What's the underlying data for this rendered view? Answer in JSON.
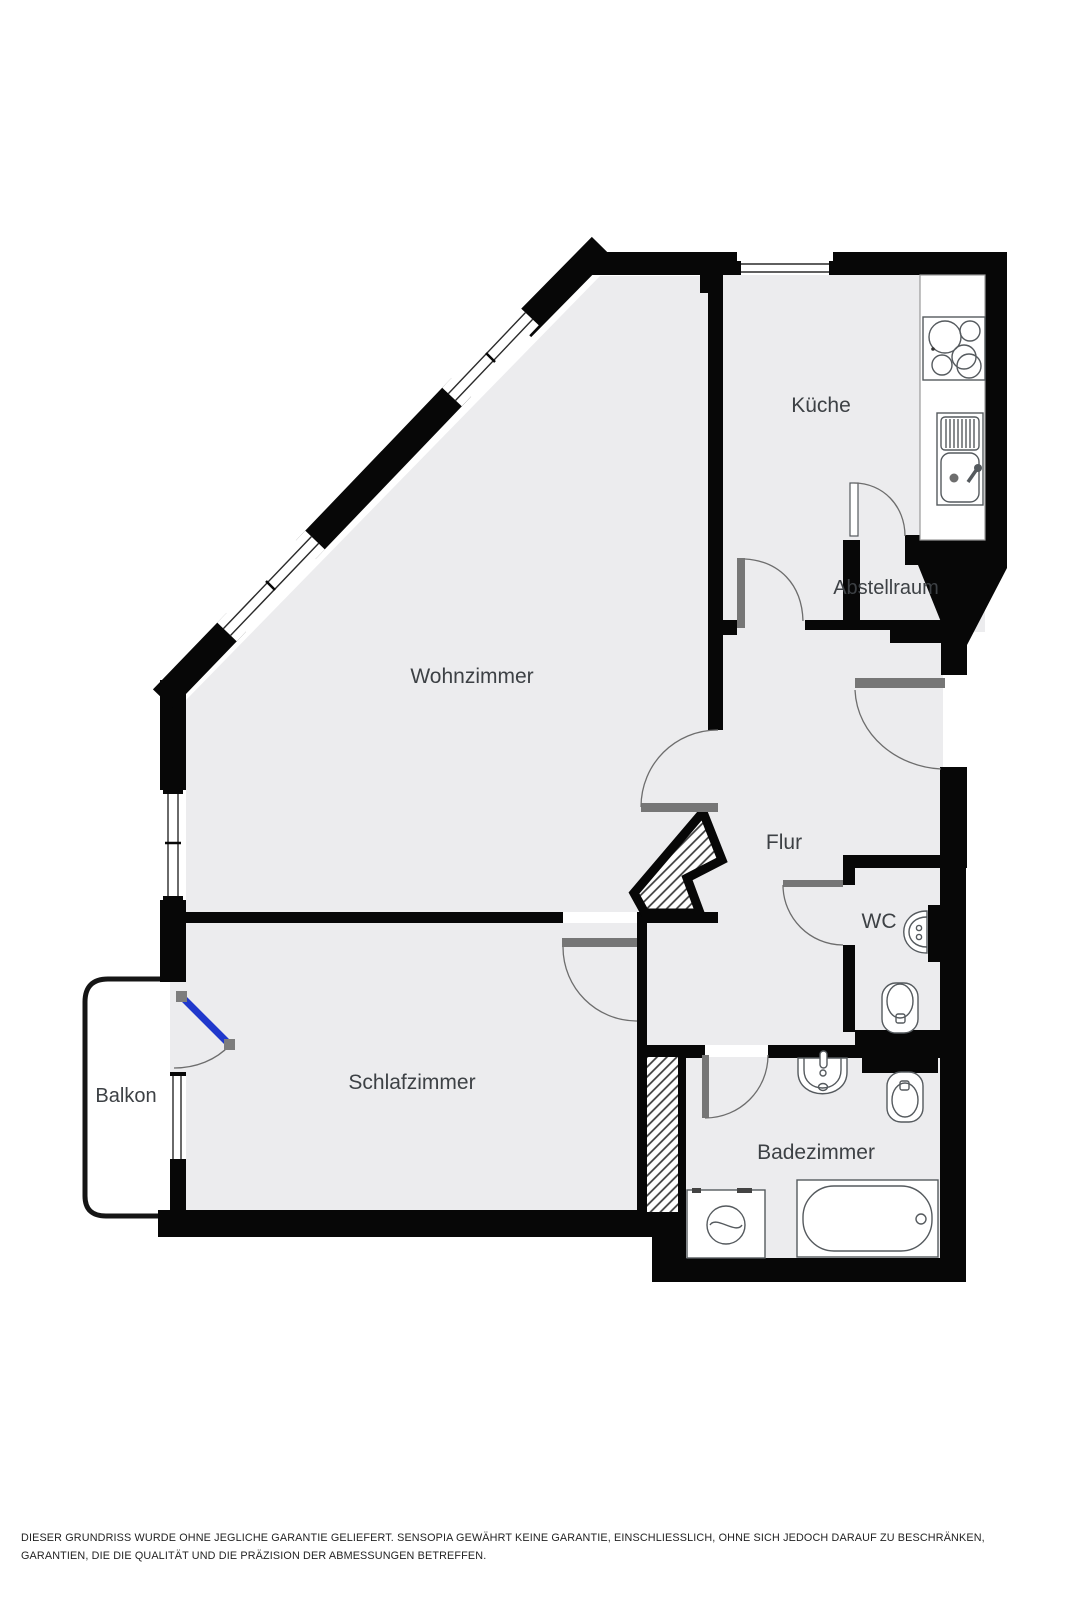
{
  "floorplan": {
    "rooms": [
      {
        "id": "kueche",
        "label": "Küche"
      },
      {
        "id": "wohnzimmer",
        "label": "Wohnzimmer"
      },
      {
        "id": "abstellraum",
        "label": "Abstellraum"
      },
      {
        "id": "flur",
        "label": "Flur"
      },
      {
        "id": "wc",
        "label": "WC"
      },
      {
        "id": "schlafzimmer",
        "label": "Schlafzimmer"
      },
      {
        "id": "balkon",
        "label": "Balkon"
      },
      {
        "id": "badezimmer",
        "label": "Badezimmer"
      }
    ],
    "fixtures": [
      "stove-icon",
      "kitchen-sink-icon",
      "wc-sink-icon",
      "wc-toilet-icon",
      "bathroom-sink-icon",
      "bathroom-toilet-icon",
      "bathtub-icon",
      "washing-machine-icon"
    ],
    "colors": {
      "wall": "#070707",
      "floor": "#ececee",
      "door_leaf": "#767676",
      "balcony_door": "#2038cc",
      "label": "#3d4145",
      "disclaimer": "#232323"
    }
  },
  "disclaimer": {
    "text": "DIESER GRUNDRISS WURDE OHNE JEGLICHE GARANTIE GELIEFERT. SENSOPIA GEWÄHRT KEINE GARANTIE, EINSCHLIESSLICH, OHNE SICH JEDOCH DARAUF ZU BESCHRÄNKEN, GARANTIEN, DIE DIE QUALITÄT UND DIE PRÄZISION DER ABMESSUNGEN BETREFFEN."
  }
}
